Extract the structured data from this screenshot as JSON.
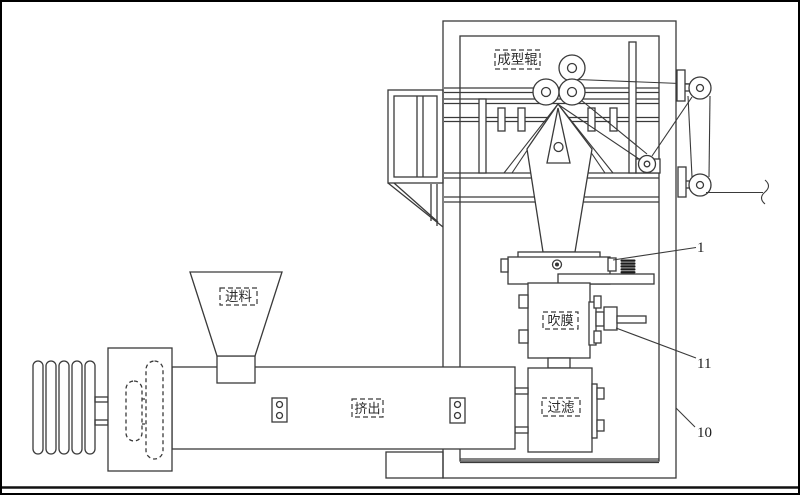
{
  "figure": {
    "labels": {
      "forming_roller": "成型辊",
      "feed": "进料",
      "extrude": "挤出",
      "blow_film": "吹膜",
      "filter": "过滤"
    },
    "refs": {
      "die_assembly": "1",
      "nozzle": "11",
      "frame": "10"
    },
    "colors": {
      "line": "#3a3a3a",
      "background": "#ffffff",
      "border": "#000000"
    }
  }
}
